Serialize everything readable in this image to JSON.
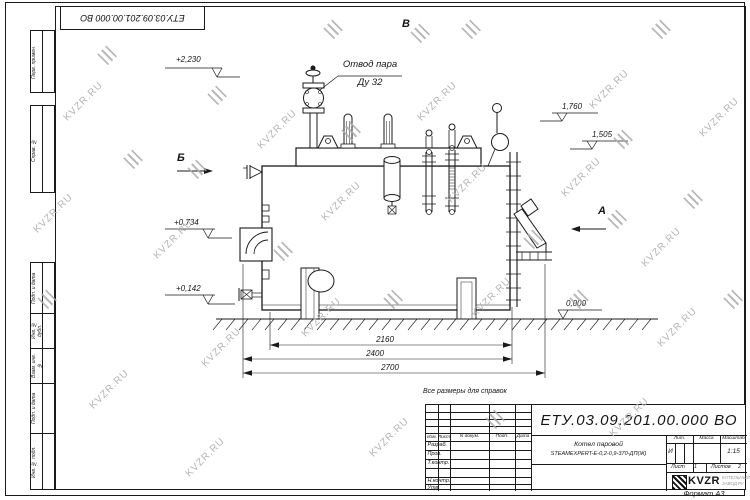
{
  "sheet": {
    "stamp_top_left": "ЕТУ.03.09.201.00.000  ВО",
    "note_above_title_block": "Все размеры для справок",
    "format_label": "Формат А3",
    "side_labels_upper": [
      "Перв. примен.",
      "Справ. №"
    ],
    "side_labels_lower": [
      "Подп. и дата",
      "Инв. № дубл.",
      "Взам. инв. №",
      "Подп. и дата",
      "Инв. № подл."
    ]
  },
  "watermark": {
    "text": "KVZR.RU",
    "color": "#b4b4b4"
  },
  "drawing": {
    "callout": {
      "line1": "Отвод пара",
      "line2": "Ду 32"
    },
    "view_labels": {
      "top": "В",
      "left": "Б",
      "right": "А"
    },
    "elevations": {
      "top": "+2,230",
      "right_upper": "1,760",
      "right_lower": "1,505",
      "left_upper": "+0,734",
      "left_lower": "+0,142",
      "ground": "0,000"
    },
    "dimensions": {
      "inner": "2160",
      "middle": "2400",
      "outer": "2700"
    }
  },
  "title_block": {
    "doc_number": "ЕТУ.03.09.201.00.000  ВО",
    "columns": {
      "izm": "Изм.",
      "list": "Лист",
      "n_dokum": "N докум.",
      "podp": "Подп.",
      "data": "Дата"
    },
    "roles": {
      "razrab": "Разраб.",
      "prov": "Пров.",
      "tkontr": "Т.контр.",
      "nkontr": "Н.контр.",
      "utv": "Утв."
    },
    "product": {
      "line1": "Котел паровой",
      "line2": "STEAMEXPERT-Е-0,2-0,9-370-ДП(Ж)"
    },
    "lit_label": "Лит.",
    "lit_value": "И",
    "mass_label": "Масса",
    "scale_label": "Масштаб",
    "scale_value": "1:15",
    "sheet_label": "Лист",
    "sheet_value": "1",
    "sheets_label": "Листов",
    "sheets_value": "2",
    "brand": {
      "name": "KVZR",
      "sub1": "КОТЕЛЬНЫЙ",
      "sub2": "ЗАВОД.РУ"
    }
  }
}
